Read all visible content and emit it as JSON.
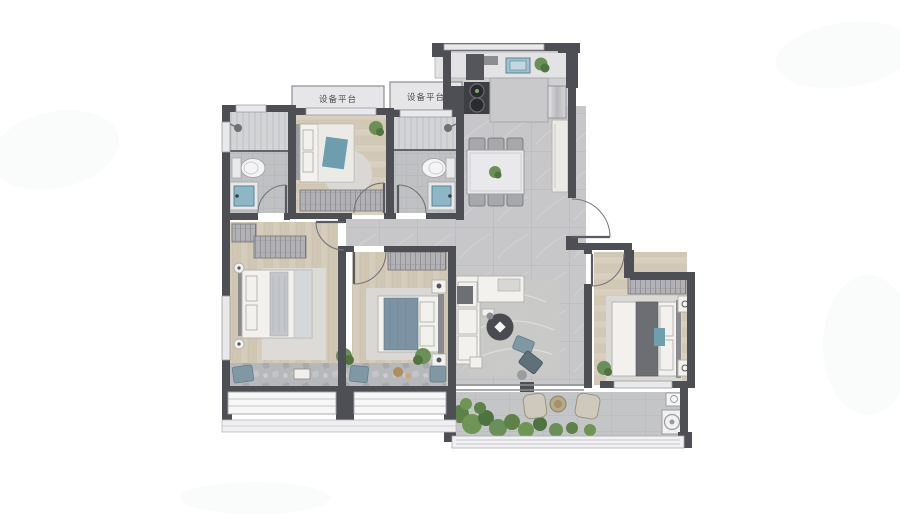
{
  "floorplan": {
    "labels": {
      "equipment_platform_left": "设备平台",
      "equipment_platform_right": "设备平台"
    },
    "colors": {
      "wall": "#4e4e55",
      "wood_floor": "#d5cbba",
      "tile_floor": "#c7c7c9",
      "bath_floor": "#bfc1c3",
      "bay_stone": "#b6b8bb",
      "accent_teal": "#6f9fae",
      "plant_green": "#6b8f58",
      "furniture_white": "#f2f1ee",
      "dark_furniture": "#4a4b51"
    },
    "rooms": [
      {
        "id": "bathroom-1",
        "furniture": [
          "shower",
          "toilet",
          "vanity-sink"
        ]
      },
      {
        "id": "bedroom-top",
        "furniture": [
          "double-bed",
          "wardrobe",
          "round-rug",
          "plant"
        ]
      },
      {
        "id": "bathroom-2",
        "furniture": [
          "shower",
          "toilet",
          "vanity-sink"
        ]
      },
      {
        "id": "kitchen",
        "furniture": [
          "counter",
          "sink",
          "stove",
          "island",
          "fridge",
          "flue"
        ]
      },
      {
        "id": "dining-area",
        "furniture": [
          "dining-table",
          "six-chairs",
          "sideboard"
        ]
      },
      {
        "id": "living-room",
        "furniture": [
          "l-sofa",
          "round-coffee-table",
          "accent-chairs",
          "tv",
          "rug"
        ]
      },
      {
        "id": "master-bedroom",
        "furniture": [
          "double-bed",
          "wardrobe",
          "tv",
          "bay-window-seat"
        ]
      },
      {
        "id": "bedroom-middle",
        "furniture": [
          "double-bed",
          "wardrobe",
          "nightstands",
          "bay-window-seat"
        ]
      },
      {
        "id": "bedroom-right",
        "furniture": [
          "double-bed",
          "wardrobe",
          "nightstands",
          "plant"
        ]
      },
      {
        "id": "balcony",
        "furniture": [
          "plants",
          "two-chairs",
          "tea-table",
          "washing-machine",
          "basin"
        ]
      },
      {
        "id": "hallway",
        "furniture": []
      },
      {
        "id": "equipment-platform-left",
        "furniture": []
      },
      {
        "id": "equipment-platform-right",
        "furniture": []
      }
    ]
  }
}
